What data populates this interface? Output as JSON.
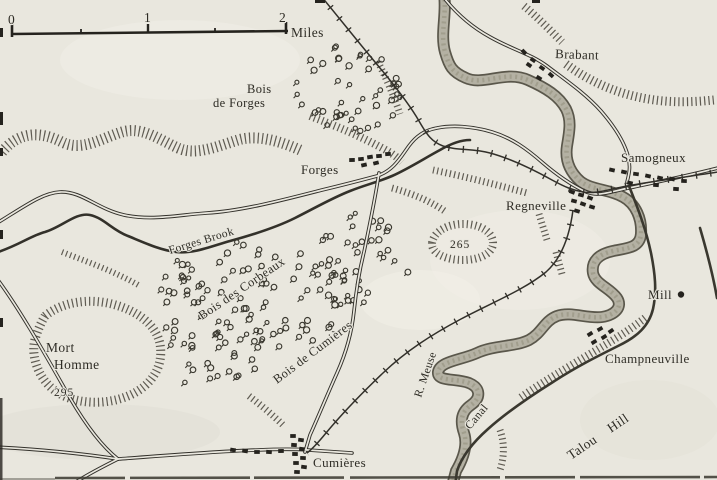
{
  "scale_bar": {
    "tick_zero": "0",
    "tick_one": "1",
    "tick_two": "2",
    "unit": "Miles"
  },
  "settlements": {
    "brabant": "Brabant",
    "forges": "Forges",
    "samogneux": "Samogneux",
    "regneville": "Regneville",
    "cumieres": "Cumières",
    "champneuville": "Champneuville",
    "mill": "Mill"
  },
  "woods": {
    "bois_de_forges_line1": "Bois",
    "bois_de_forges_line2": "de Forges",
    "bois_des_corbeaux": "Bois des Corbeaux",
    "bois_de_cumieres": "Bois de Cumières"
  },
  "water": {
    "forges_brook": "Forges Brook",
    "meuse_river": "R. Meuse",
    "canal": "Canal"
  },
  "hills": {
    "mort_homme_line1": "Mort",
    "mort_homme_line2": "Homme",
    "mort_homme_elevation": "295",
    "hill_265_elevation": "265",
    "talou_hill": "Talou Hill"
  },
  "colors": {
    "ink": "#32302a",
    "paper": "#e9e7de",
    "river_fill": "#b4b1a3",
    "river_edge": "#5a574b",
    "hachure": "#4b483f"
  }
}
